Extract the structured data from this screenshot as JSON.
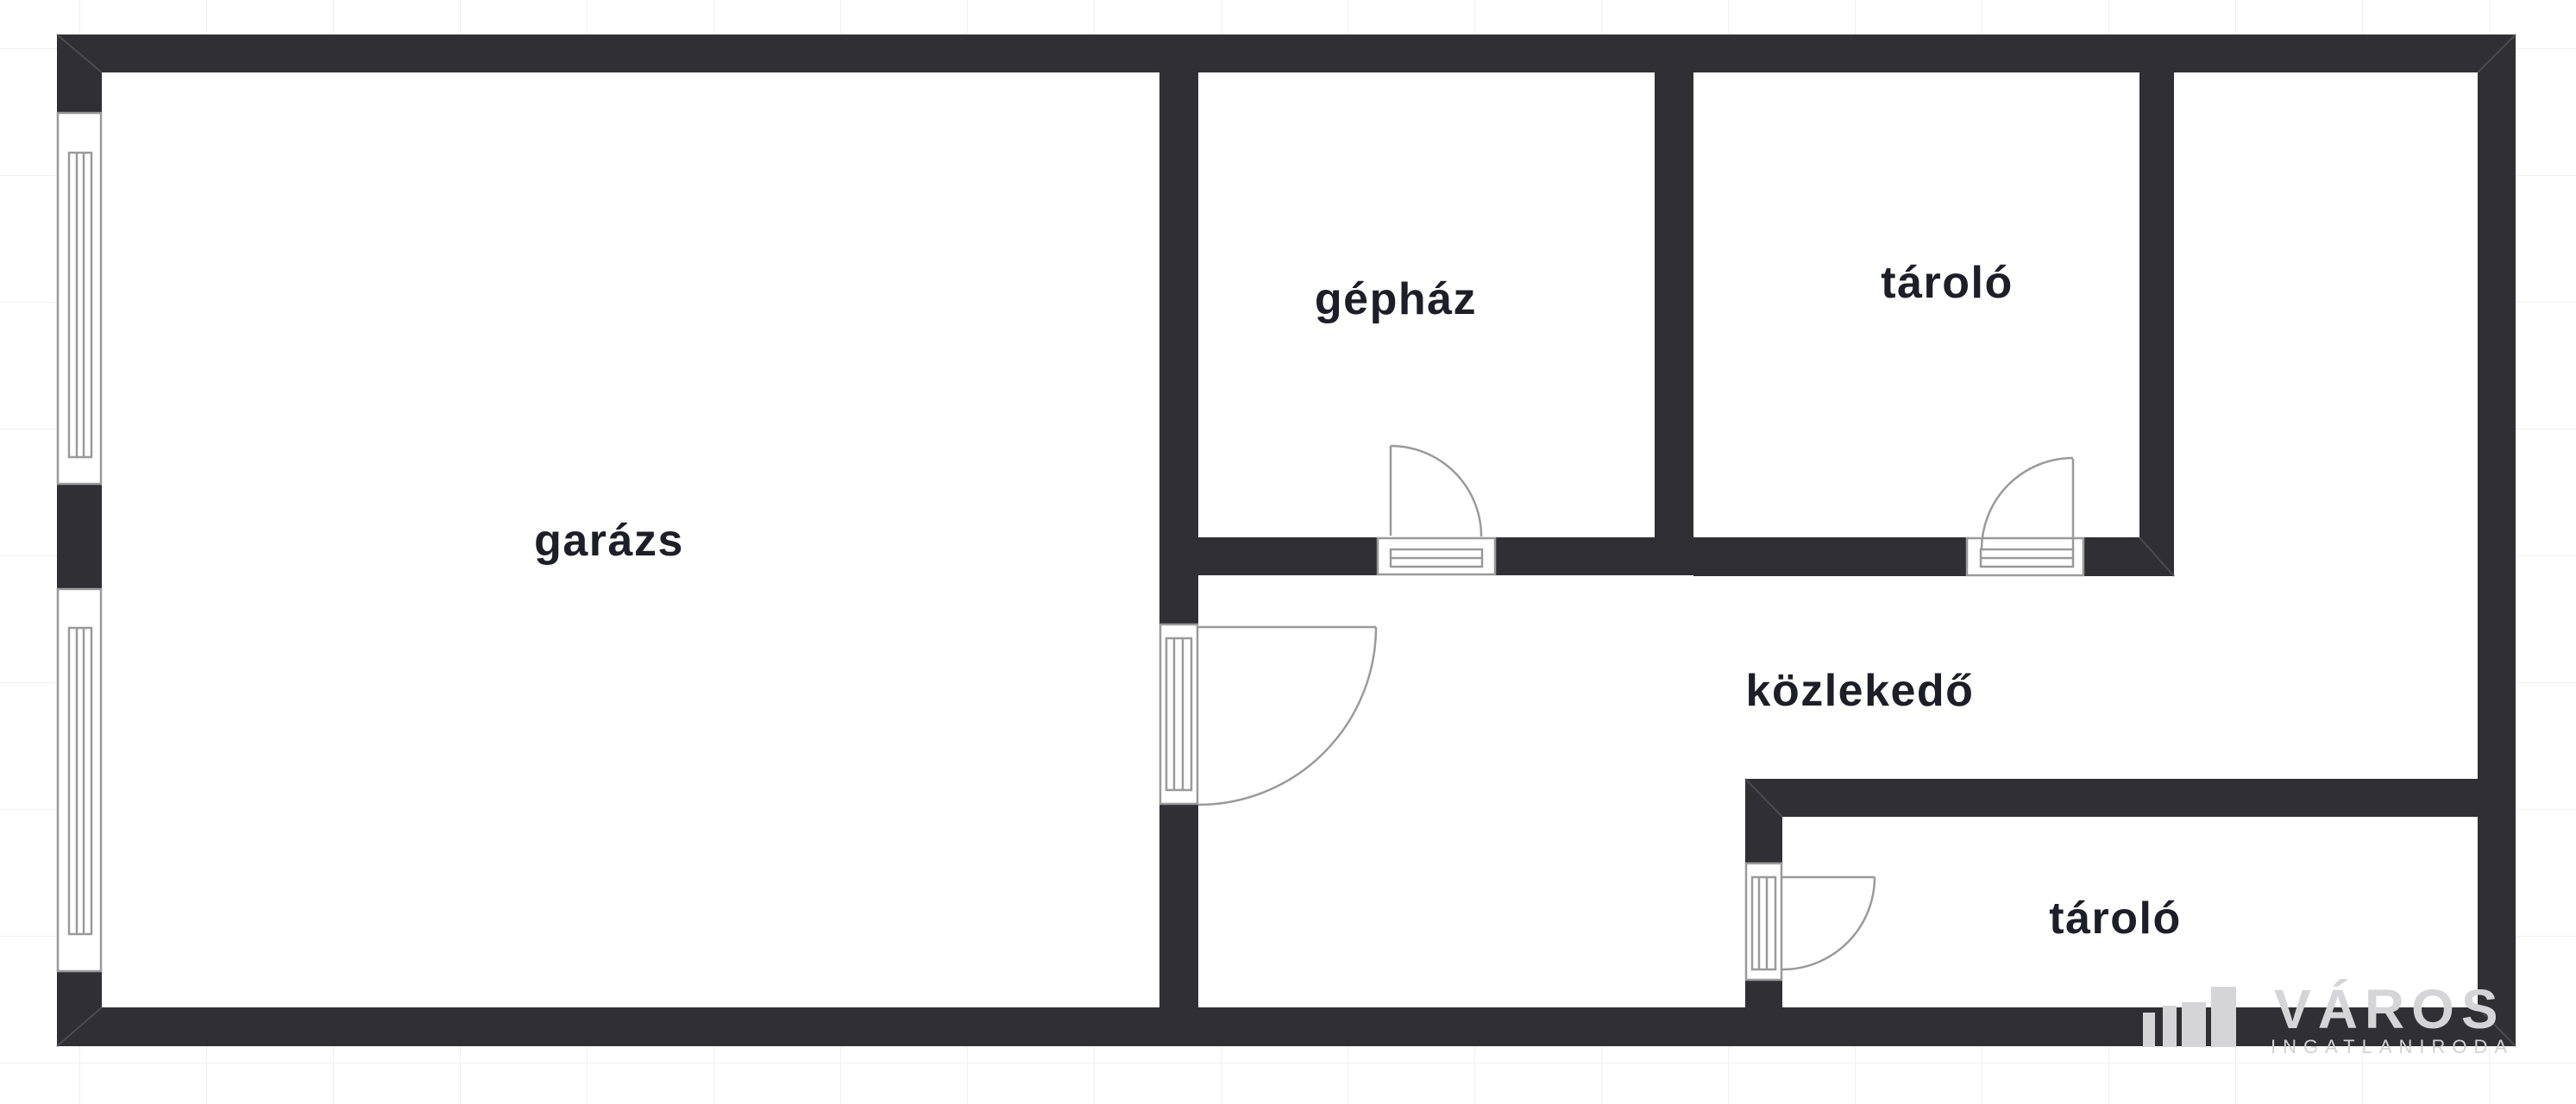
{
  "plan": {
    "type": "floorplan",
    "rooms": [
      {
        "id": "garazs",
        "label": "garázs"
      },
      {
        "id": "gephaz",
        "label": "gépház"
      },
      {
        "id": "tarolo_felso",
        "label": "tároló"
      },
      {
        "id": "kozlekedo",
        "label": "közlekedő"
      },
      {
        "id": "tarolo_also",
        "label": "tároló"
      }
    ],
    "features": {
      "windows": 2,
      "doors": 4
    },
    "colors": {
      "background": "#ffffff",
      "floor": "#ffffff",
      "wall": "#303034",
      "wall_seam": "#4e4e54",
      "symbol_stroke": "#9a9a9a",
      "grid_line": "#f0f0f1",
      "room_label": "#1e1e28",
      "watermark": "#d5d5d7"
    }
  },
  "watermark": {
    "logo_icon": "bar-chart-building-icon",
    "brand": "VÁROS",
    "subtitle": "INGATLANIRODA"
  }
}
